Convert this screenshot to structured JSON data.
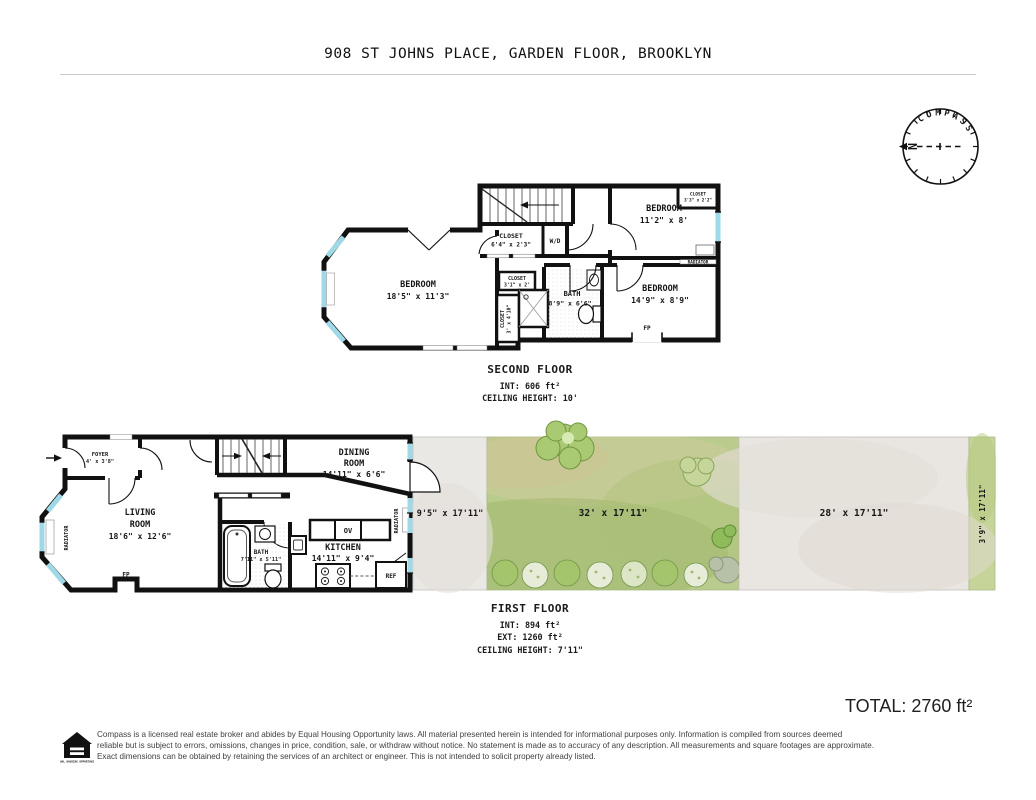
{
  "title": "908 ST JOHNS PLACE, GARDEN FLOOR, BROOKLYN",
  "compass": {
    "label": "COMPASS",
    "north": "N"
  },
  "floors": {
    "second": {
      "heading": "SECOND FLOOR",
      "line1": "INT: 606 ft²",
      "line2": "CEILING HEIGHT: 10'"
    },
    "first": {
      "heading": "FIRST FLOOR",
      "line1": "INT: 894 ft²",
      "line2": "EXT: 1260 ft²",
      "line3": "CEILING HEIGHT: 7'11\""
    }
  },
  "second_floor": {
    "bedroom_left": {
      "name": "BEDROOM",
      "dims": "18'5\" x 11'3\""
    },
    "closet_hall": {
      "name": "CLOSET",
      "dims": "6'4\" x 2'3\""
    },
    "wd": "W/D",
    "bedroom_top_right": {
      "name": "BEDROOM",
      "dims": "11'2\" x 8'"
    },
    "closet_top_right": {
      "name": "CLOSET",
      "dims": "3'3\" x 2'2\""
    },
    "radiator": "RADIATOR",
    "closet_mid": {
      "name": "CLOSET",
      "dims": "3'1\" x 2'"
    },
    "closet_tall": {
      "name": "CLOSET",
      "dims": "3' x 4'10\""
    },
    "bath": {
      "name": "BATH",
      "dims": "8'9\" x 6'6\""
    },
    "bedroom_bottom_right": {
      "name": "BEDROOM",
      "dims": "14'9\" x 8'9\""
    },
    "fireplace": "FP"
  },
  "first_floor": {
    "foyer": {
      "name": "FOYER",
      "dims": "4' x 3'8\""
    },
    "living_room": {
      "name": "LIVING",
      "name2": "ROOM",
      "dims": "18'6\" x 12'6\""
    },
    "radiator_left": "RADIATOR",
    "fireplace": "FP",
    "dining_room": {
      "name": "DINING",
      "name2": "ROOM",
      "dims": "14'11\" x 6'6\""
    },
    "bath": {
      "name": "BATH",
      "dims": "7'11\" x 5'11\""
    },
    "kitchen": {
      "name": "KITCHEN",
      "dims": "14'11\" x 9'4\""
    },
    "oven": "OV",
    "fridge": "REF",
    "radiator_right": "RADIATOR",
    "outdoor": {
      "patio": "9'5\" x 17'11\"",
      "garden": "32' x 17'11\"",
      "yard": "28' x 17'11\"",
      "side_strip": "3'9\" x 17'11\""
    }
  },
  "total": "TOTAL: 2760 ft²",
  "footer": {
    "lines": [
      "Compass is a licensed real estate broker and abides by Equal Housing Opportunity laws. All material presented herein is intended for informational purposes only. Information is compiled from sources deemed",
      "reliable but is subject to errors, omissions, changes in price, condition, sale, or withdraw without notice. No statement is made as to accuracy of any description. All measurements and square footages are approximate.",
      "Exact dimensions can be obtained by retaining the services of an architect or engineer. This is not intended to solicit property already listed."
    ],
    "logo_text": "EQUAL HOUSING OPPORTUNITY"
  },
  "colors": {
    "wall": "#111111",
    "window": "#9fd8e6",
    "garden_green": "#b9cb8d",
    "patio_gray": "#eae8e5",
    "north_red": "#cc2a1e"
  }
}
